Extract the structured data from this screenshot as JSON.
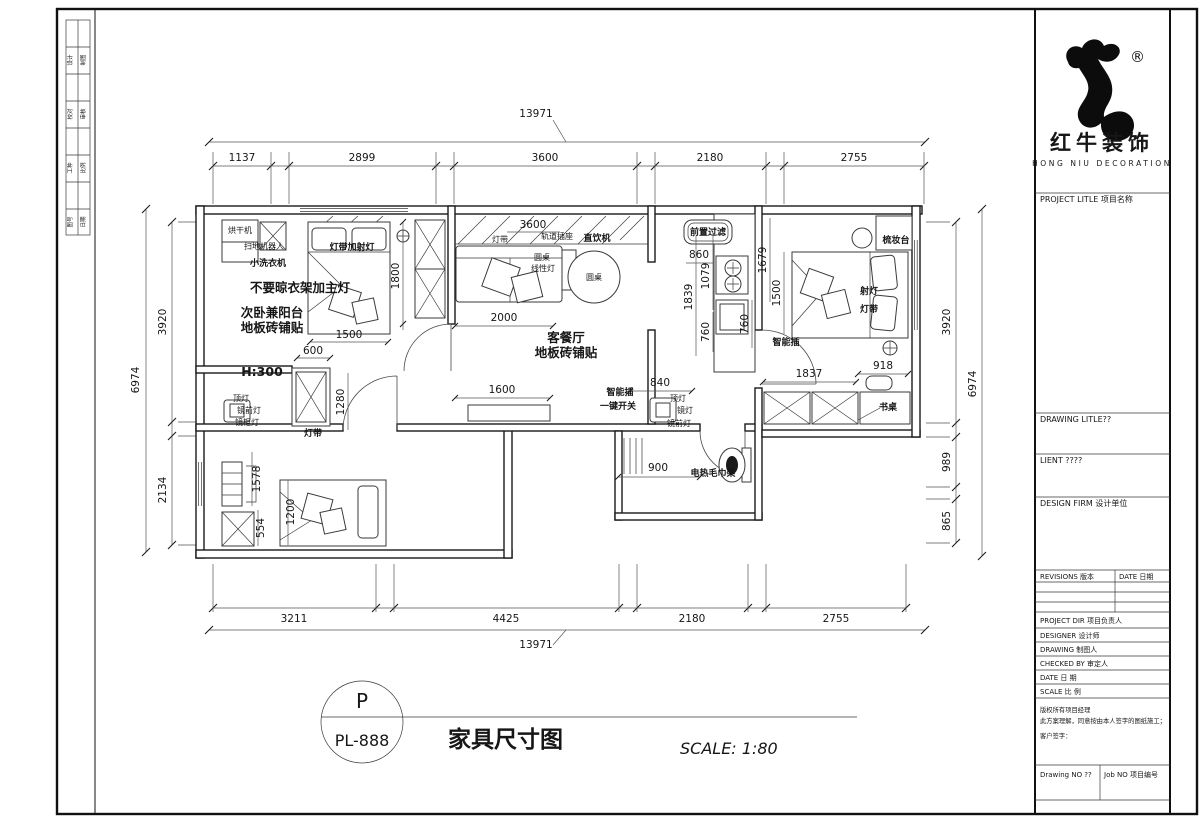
{
  "brand": {
    "registered": "®",
    "name_cn": "红牛装饰",
    "name_en": "HONG NIU DECORATION"
  },
  "title_block": {
    "project_title": "PROJECT LITLE  项目名称",
    "drawing_title": "DRAWING LITLE??",
    "client": "LIENT ????",
    "design_firm": "DESIGN FIRM 设计单位",
    "revisions": "REVISIONS 版本",
    "revision_date": "DATE 日期",
    "rows": [
      "PROJECT DIR    项目负责人",
      "DESIGNER       设计师",
      "DRAWING        制图人",
      "CHECKED BY     审定人",
      "DATE           日 期",
      "SCALE          比 例"
    ],
    "copyright_1": "版权所有项目经理",
    "copyright_2": "此方案理解，同意按由本人签字的图纸施工；",
    "customer_sign": "客户签字：",
    "drawing_no": "Drawing NO ??",
    "job_no": "Job NO 项目编号"
  },
  "footer": {
    "tag_letter": "P",
    "tag_code": "PL-888",
    "drawing_name": "家具尺寸图",
    "scale_text": "SCALE: 1:80"
  },
  "edge_strip": {
    "cells": [
      "设计",
      "制图",
      "校对",
      "审核",
      "工种",
      "比例",
      "图号",
      "日期"
    ]
  },
  "plan": {
    "dims": {
      "top_overall": "13971",
      "top_segments": [
        "1137",
        "2899",
        "3600",
        "2180",
        "2755"
      ],
      "bottom_overall": "13971",
      "bottom_segments": [
        "3211",
        "4425",
        "2180",
        "2755"
      ],
      "left_overall": "6974",
      "left_segments": [
        "3920",
        "2134"
      ],
      "right_overall": "6974",
      "right_segments": [
        "3920",
        "989",
        "865"
      ],
      "interior": {
        "bed1_width": "1500",
        "bed1_gap": "600",
        "bed1_closet": "1800",
        "living_top": "3600",
        "sofa": "2000",
        "tv": "1600",
        "k860": "860",
        "k1079": "1079",
        "k1839": "1839",
        "k760a": "760",
        "k760b": "760",
        "m1679": "1679",
        "m1500": "1500",
        "m918": "918",
        "m1837": "1837",
        "v840": "840",
        "b900": "900",
        "c1280": "1280",
        "c1578": "1578",
        "c1200": "1200",
        "c554": "554",
        "h300": "H:300"
      }
    },
    "labels": {
      "dryer": "烘干机",
      "robot": "扫地机器人",
      "mini_washer": "小洗衣机",
      "strip_spot": "灯带加射灯",
      "no_rack": "不要晾衣架加主灯",
      "room2_a": "次卧兼阳台",
      "room2_b": "地板砖铺贴",
      "dome1": "顶灯",
      "mirror_front1": "镜前灯",
      "mirror_cab": "镜柜灯",
      "strip1": "灯带",
      "strip2": "灯带",
      "track_socket": "轨道插座",
      "water": "直饮机",
      "round_small": "圆桌",
      "linear": "线性灯",
      "round_table": "圆桌",
      "living_a": "客餐厅",
      "living_b": "地板砖铺贴",
      "prefilter": "前置过滤",
      "smart1": "智能插",
      "onekey": "一键开关",
      "dome2": "顶灯",
      "mirror2": "镜灯",
      "mirror_front2": "镜前灯",
      "towel": "电热毛巾架",
      "smart2": "智能插",
      "dresser": "梳妆台",
      "spot": "射灯",
      "strip3": "灯带",
      "desk": "书桌"
    }
  }
}
